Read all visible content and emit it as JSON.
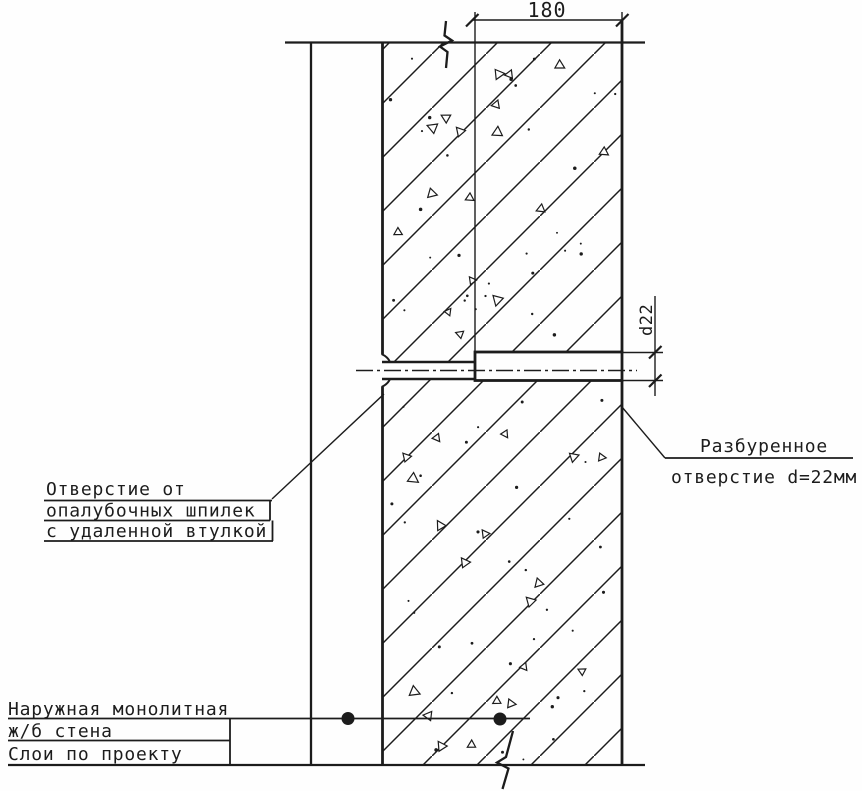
{
  "drawing": {
    "colors": {
      "ink": "#1c1c1c",
      "paper": "#fefefe"
    },
    "dimensions": {
      "wall_width": "180",
      "hole_diameter": "d22"
    },
    "callouts": {
      "formwork_hole": {
        "line1": "Отверстие от",
        "line2": "опалубочных шпилек",
        "line3": "с удаленной втулкой"
      },
      "drilled_hole": {
        "line1": "Разбуренное",
        "line2": "отверстие d=22мм"
      },
      "wall": {
        "line1": "Наружная монолитная",
        "line2": "ж/б стена",
        "line3": "Слои по проекту"
      }
    }
  }
}
